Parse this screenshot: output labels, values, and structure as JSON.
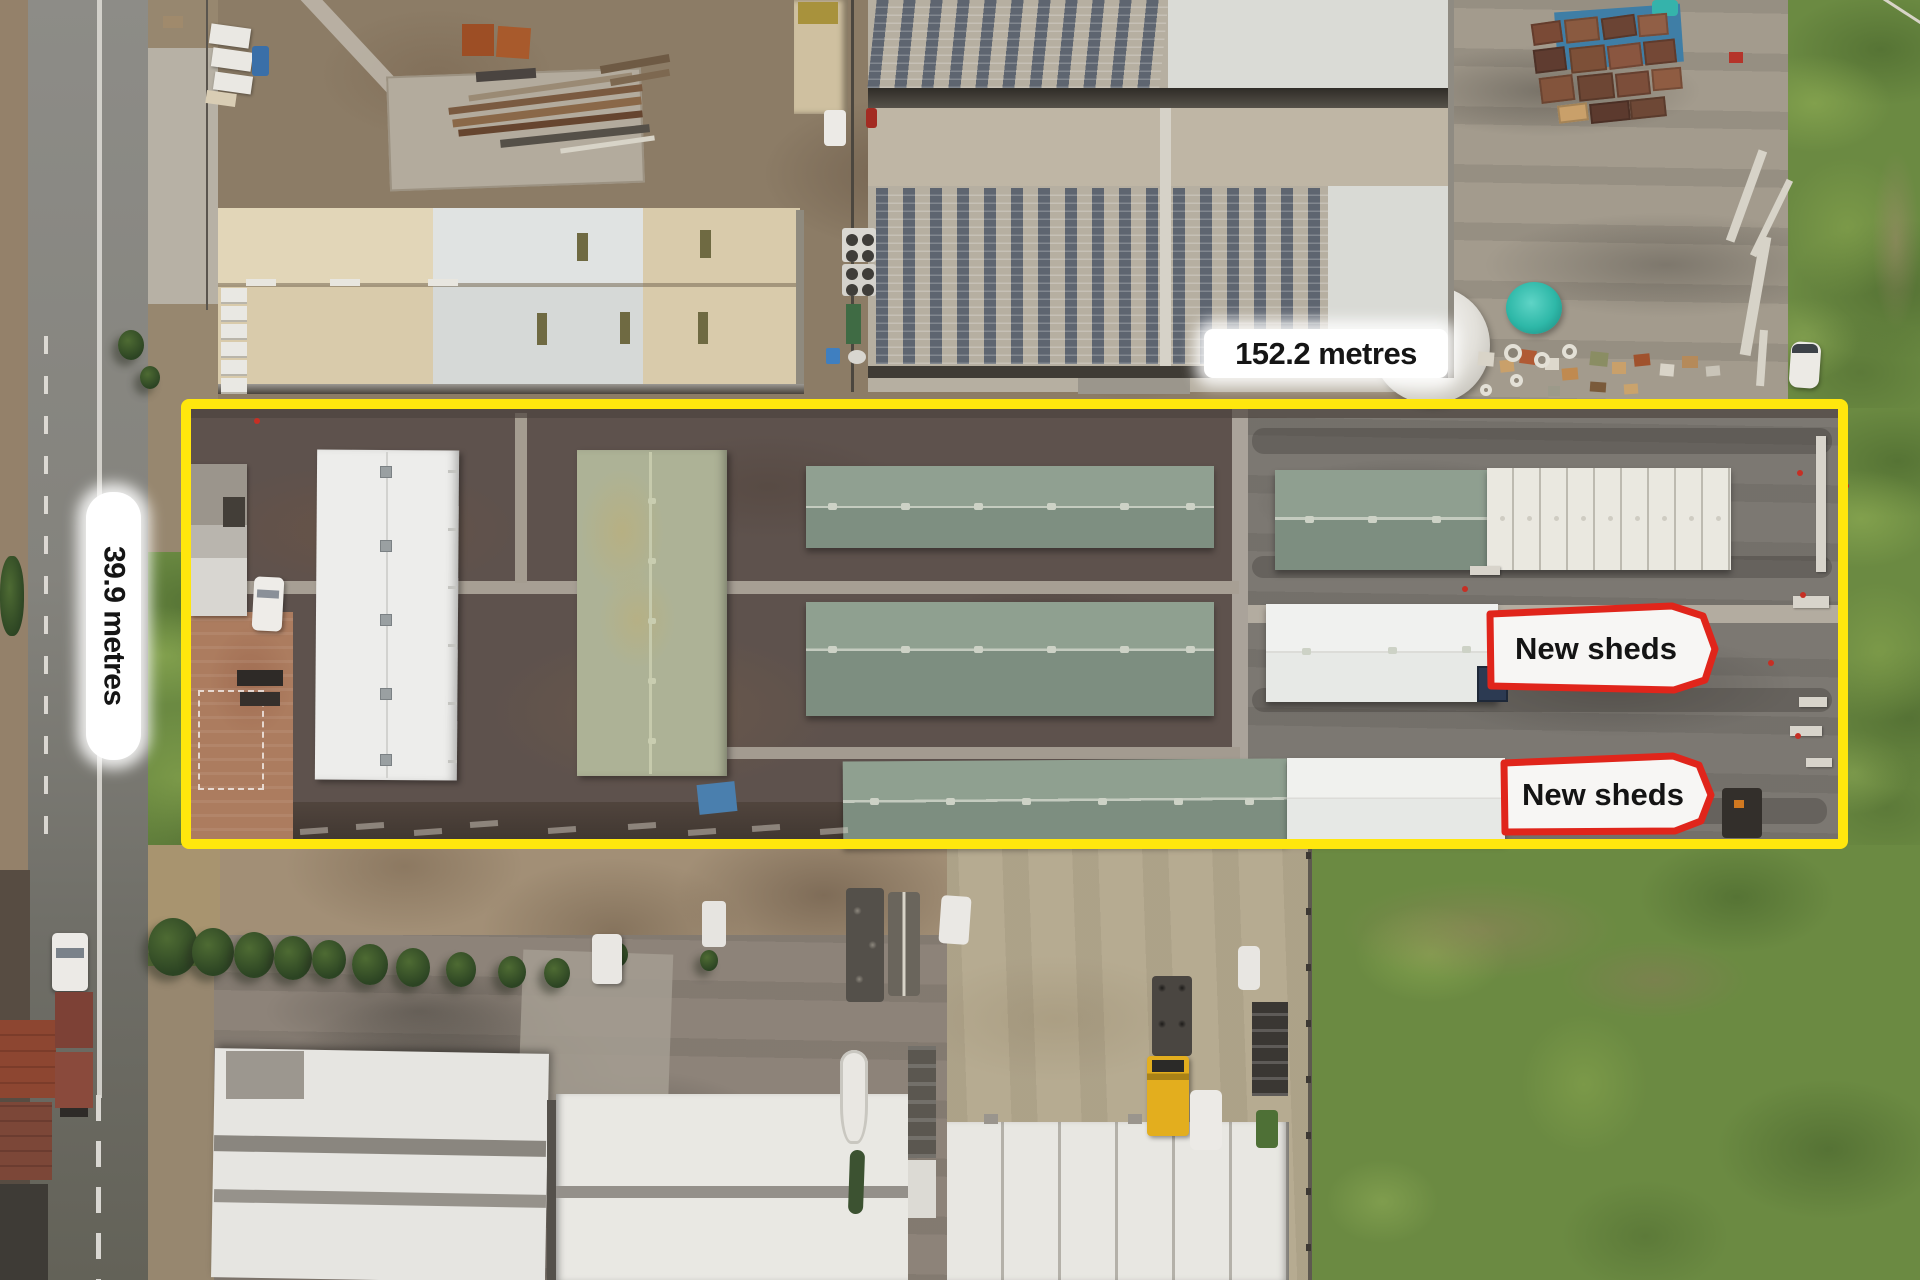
{
  "image": {
    "description": "Aerial drone photo of an industrial yard; a long narrow lot is outlined in yellow with site dimensions and two callouts marking new sheds",
    "width_px": 1920,
    "height_px": 1280
  },
  "annotations": {
    "width_label": "152.2 metres",
    "height_label": "39.9 metres",
    "new_sheds_labels": [
      "New sheds",
      "New sheds"
    ]
  },
  "colors": {
    "site_boundary_yellow": "#FFE70D",
    "new_sheds_outline_red": "#E0251B",
    "dimension_label_bg": "#FFFFFF",
    "dimension_label_text": "#151515"
  }
}
